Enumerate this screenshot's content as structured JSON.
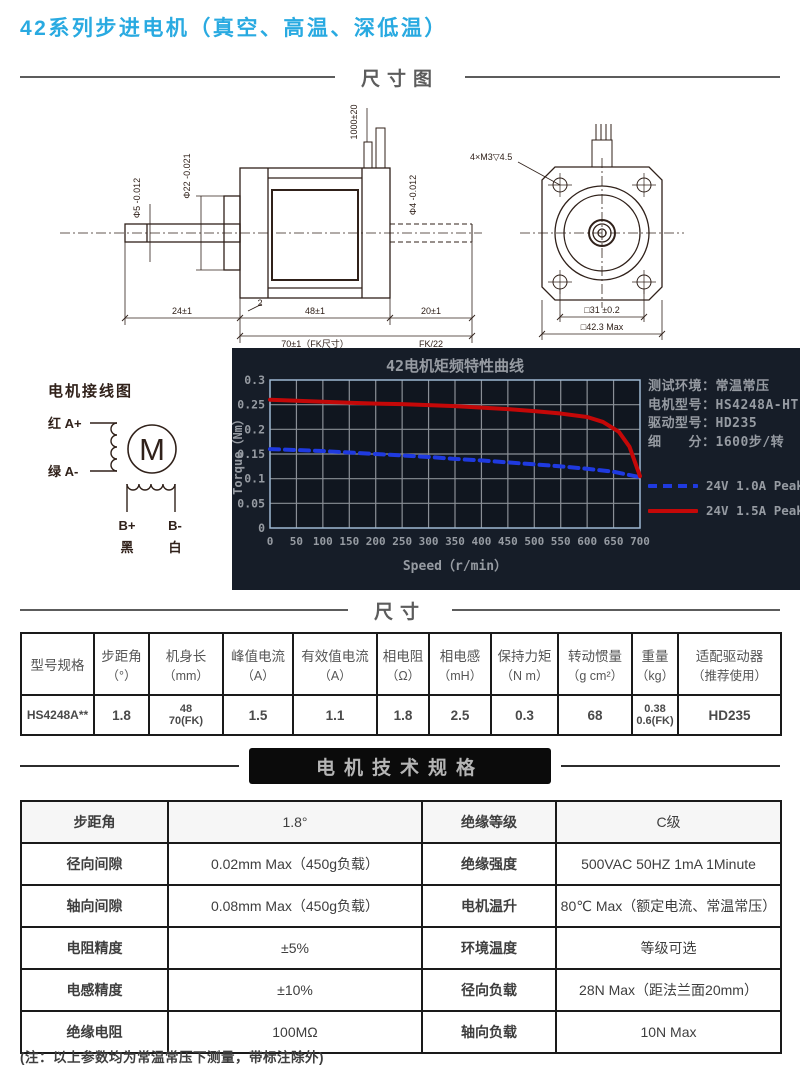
{
  "page": {
    "title": "42系列步进电机（真空、高温、深低温）"
  },
  "sections": {
    "dimension_drawing": "尺寸图",
    "dimensions": "尺寸",
    "specs": "电机技术规格"
  },
  "drawing": {
    "side": {
      "wire_length": "1000±20",
      "shaft_dia": "Φ5 -0.012",
      "pilot_dia": "Φ22 -0.021",
      "rear_shaft_dia": "Φ4 -0.012",
      "step": "2",
      "shaft_len": "24±1",
      "body_len": "48±1",
      "body_len_fk": "70±1（FK尺寸）",
      "rear_len": "20±1",
      "rear_len_fk": "FK/22"
    },
    "front": {
      "holes": "4×M3▽4.5",
      "square_inner": "□31 ±0.2",
      "square_outer": "□42.3 Max"
    }
  },
  "wiring": {
    "title": "电机接线图",
    "a_plus": "红 A+",
    "a_minus": "绿 A-",
    "motor": "M",
    "b_plus": "B+",
    "b_minus": "B-",
    "black": "黑",
    "white": "白"
  },
  "chart_data": {
    "type": "line",
    "title": "42电机矩频特性曲线",
    "xlabel": "Speed（r/min）",
    "ylabel": "Torque（Nm）",
    "xlim": [
      0,
      700
    ],
    "ylim": [
      0,
      0.3
    ],
    "x_ticks": [
      0,
      50,
      100,
      150,
      200,
      250,
      300,
      350,
      400,
      450,
      500,
      550,
      600,
      650,
      700
    ],
    "y_ticks": [
      0.3,
      0.25,
      0.2,
      0.15,
      0.1,
      0.05,
      0
    ],
    "grid": true,
    "legend_position": "right",
    "bg": "#161d28",
    "plot_bg": "#10161f",
    "grid_color": "#8a8f96",
    "border_color": "#9db8d2",
    "text_color": "#969ba2",
    "series": [
      {
        "name": "24V 1.0A Peak",
        "color": "#1f3ae0",
        "dashed": true,
        "points": [
          [
            0,
            0.16
          ],
          [
            50,
            0.158
          ],
          [
            100,
            0.156
          ],
          [
            150,
            0.153
          ],
          [
            200,
            0.15
          ],
          [
            250,
            0.147
          ],
          [
            300,
            0.144
          ],
          [
            350,
            0.14
          ],
          [
            400,
            0.137
          ],
          [
            450,
            0.133
          ],
          [
            500,
            0.129
          ],
          [
            550,
            0.125
          ],
          [
            600,
            0.12
          ],
          [
            650,
            0.114
          ],
          [
            700,
            0.103
          ]
        ]
      },
      {
        "name": "24V 1.5A Peak",
        "color": "#c40808",
        "dashed": false,
        "points": [
          [
            0,
            0.26
          ],
          [
            50,
            0.258
          ],
          [
            100,
            0.256
          ],
          [
            150,
            0.254
          ],
          [
            200,
            0.252
          ],
          [
            250,
            0.251
          ],
          [
            300,
            0.249
          ],
          [
            350,
            0.247
          ],
          [
            400,
            0.244
          ],
          [
            450,
            0.241
          ],
          [
            500,
            0.237
          ],
          [
            550,
            0.232
          ],
          [
            600,
            0.225
          ],
          [
            630,
            0.215
          ],
          [
            660,
            0.195
          ],
          [
            680,
            0.165
          ],
          [
            700,
            0.105
          ]
        ]
      }
    ]
  },
  "chart_info": {
    "rows": [
      {
        "label": "测试环境：",
        "value": "常温常压"
      },
      {
        "label": "电机型号：",
        "value": "HS4248A-HT"
      },
      {
        "label": "驱动型号：",
        "value": "HD235"
      },
      {
        "label": "细　　分：",
        "value": "1600步/转"
      }
    ]
  },
  "dim_table": {
    "headers": [
      {
        "name": "型号规格",
        "unit": ""
      },
      {
        "name": "步距角",
        "unit": "（°）"
      },
      {
        "name": "机身长",
        "unit": "（mm）"
      },
      {
        "name": "峰值电流",
        "unit": "（A）"
      },
      {
        "name": "有效值电流",
        "unit": "（A）"
      },
      {
        "name": "相电阻",
        "unit": "（Ω）"
      },
      {
        "name": "相电感",
        "unit": "（mH）"
      },
      {
        "name": "保持力矩",
        "unit": "（N m）"
      },
      {
        "name": "转动惯量",
        "unit": "（g cm²）"
      },
      {
        "name": "重量",
        "unit": "（kg）"
      },
      {
        "name": "适配驱动器",
        "unit": "（推荐使用）"
      }
    ],
    "row": {
      "model": "HS4248A**",
      "step_angle": "1.8",
      "body_length_1": "48",
      "body_length_2": "70(FK)",
      "peak_current": "1.5",
      "rms_current": "1.1",
      "resistance": "1.8",
      "inductance": "2.5",
      "holding_torque": "0.3",
      "inertia": "68",
      "weight_1": "0.38",
      "weight_2": "0.6(FK)",
      "driver": "HD235"
    }
  },
  "spec_table": {
    "rows": [
      {
        "l1": "步距角",
        "v1": "1.8°",
        "l2": "绝缘等级",
        "v2": "C级"
      },
      {
        "l1": "径向间隙",
        "v1": "0.02mm Max（450g负载）",
        "l2": "绝缘强度",
        "v2": "500VAC 50HZ 1mA 1Minute"
      },
      {
        "l1": "轴向间隙",
        "v1": "0.08mm Max（450g负载）",
        "l2": "电机温升",
        "v2": "80℃ Max（额定电流、常温常压）"
      },
      {
        "l1": "电阻精度",
        "v1": "±5%",
        "l2": "环境温度",
        "v2": "等级可选"
      },
      {
        "l1": "电感精度",
        "v1": "±10%",
        "l2": "径向负载",
        "v2": "28N Max（距法兰面20mm）"
      },
      {
        "l1": "绝缘电阻",
        "v1": "100MΩ",
        "l2": "轴向负载",
        "v2": "10N Max"
      }
    ]
  },
  "footer_note": "(注：以上参数均为常温常压下测量，带标注除外)"
}
